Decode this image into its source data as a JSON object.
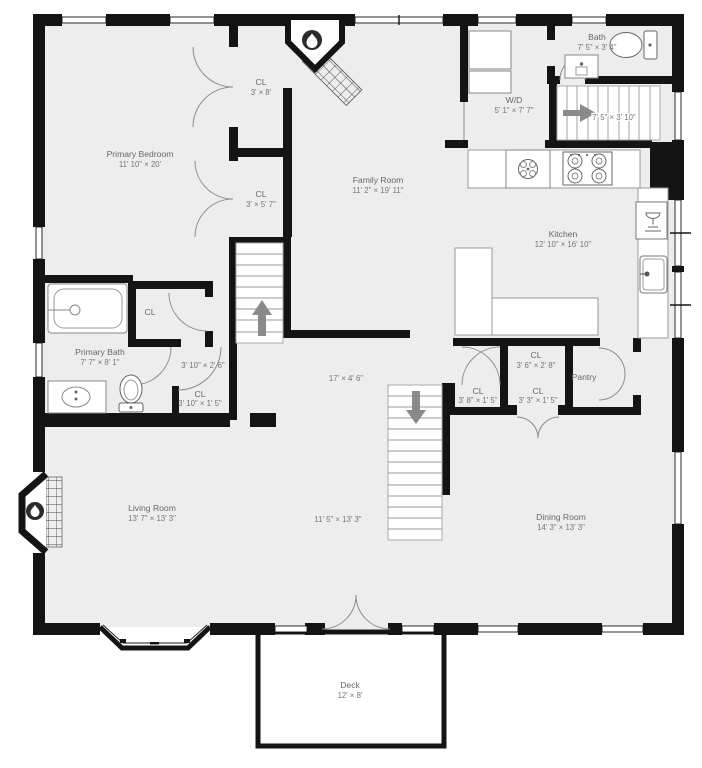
{
  "plan_title": "First floor plan",
  "colors": {
    "floor": "#ededed",
    "wall": "#141414",
    "label": "#676767",
    "arrow": "#8a8a8a",
    "fixture_stroke": "#888888",
    "door_arc": "#8c8c8c"
  },
  "rooms": {
    "primary_bedroom": {
      "name": "Primary Bedroom",
      "dims": "11' 10\" × 20'"
    },
    "closet_top": {
      "name": "CL",
      "dims": "3' × 8'"
    },
    "closet_mid": {
      "name": "CL",
      "dims": "3' × 5' 7\""
    },
    "family_room": {
      "name": "Family Room",
      "dims": "11' 2\" × 19' 11\""
    },
    "laundry": {
      "name": "W/D",
      "dims": "5' 1\" × 7' 7\""
    },
    "bath": {
      "name": "Bath",
      "dims": "7' 5\" × 3' 4\""
    },
    "stairs_upper": {
      "dims": "7' 5\" × 3' 10\""
    },
    "kitchen": {
      "name": "Kitchen",
      "dims": "12' 10\" × 16' 10\""
    },
    "closet_bath": {
      "name": "CL"
    },
    "primary_bath": {
      "name": "Primary Bath",
      "dims": "7' 7\" × 8' 1\""
    },
    "vestibule": {
      "dims": "3' 10\" × 2' 6\""
    },
    "closet_hall": {
      "name": "CL",
      "dims": "3' 10\" × 1' 5\""
    },
    "hallway": {
      "dims": "17' × 4' 6\""
    },
    "closet_36": {
      "name": "CL",
      "dims": "3' 6\" × 2' 8\""
    },
    "pantry": {
      "name": "Pantry"
    },
    "closet_38": {
      "name": "CL",
      "dims": "3' 8\" × 1' 5\""
    },
    "closet_33": {
      "name": "CL",
      "dims": "3' 3\" × 1' 5\""
    },
    "living_room": {
      "name": "Living Room",
      "dims": "13' 7\" × 13' 3\""
    },
    "foyer": {
      "dims": "11' 5\" × 13' 3\""
    },
    "dining_room": {
      "name": "Dining Room",
      "dims": "14' 3\" × 13' 3\""
    },
    "deck": {
      "name": "Deck",
      "dims": "12' × 8'"
    }
  },
  "icons": {
    "fireplace_family": "flame-icon",
    "fireplace_living": "flame-icon",
    "stairs_center": "arrow-up-icon",
    "stairs_upper": "arrow-right-icon",
    "stairs_lower": "arrow-down-icon"
  }
}
